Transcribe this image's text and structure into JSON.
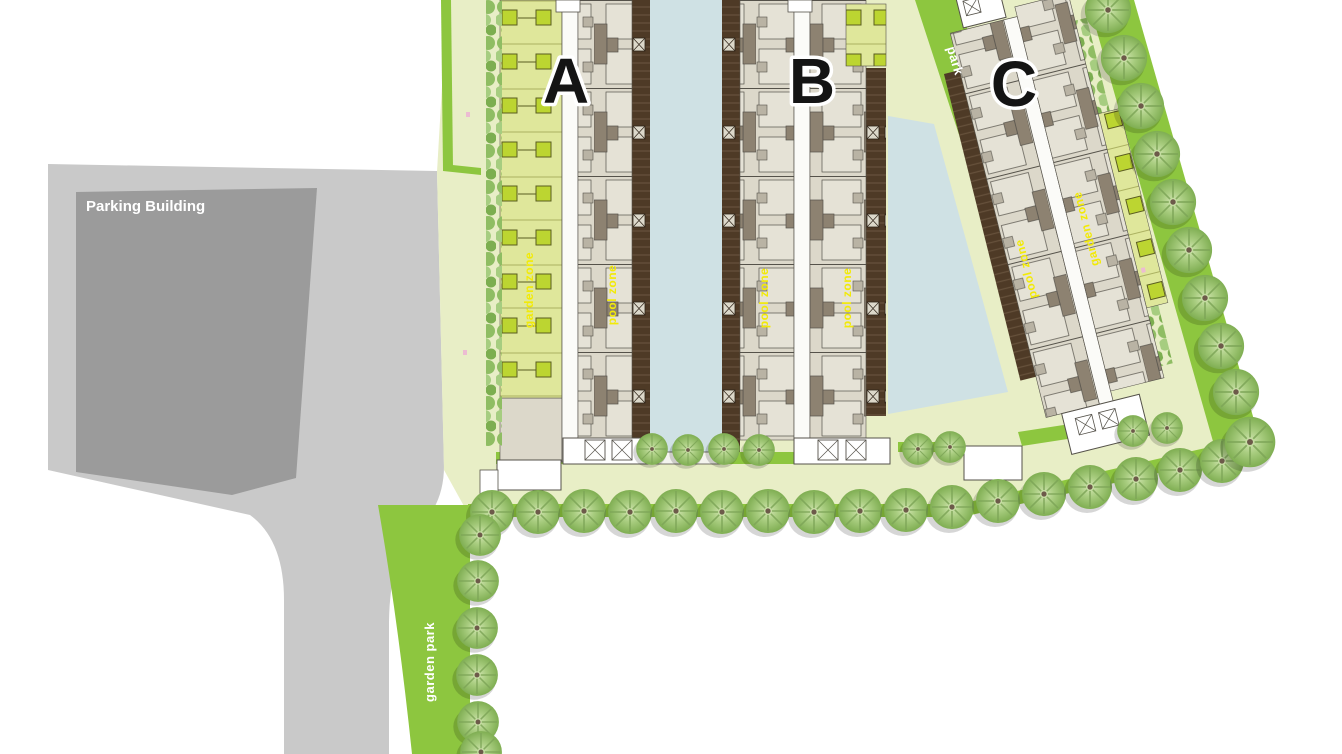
{
  "labels": {
    "parking_building": "Parking Building",
    "tower_a": "A",
    "tower_b": "B",
    "tower_c": "C",
    "garden_park": "garden park",
    "park_ribbon": "park",
    "zones": {
      "a_garden": "garden zone",
      "a_pool": "pool zone",
      "b_pool_left": "pool zone",
      "b_pool_right": "pool zone",
      "c_pool": "pool zone",
      "c_garden": "garden zone"
    }
  },
  "colors": {
    "bg": "#ffffff",
    "roadGray": "#c9c9c9",
    "parkGray": "#9b9b9b",
    "field": "#e8eec6",
    "green": "#8dc63f",
    "pool": "#cfe1e4",
    "deckBrown": "#4e3a26",
    "deckLine": "#66513b",
    "beige": "#dcd8ca",
    "beige2": "#e5e2d6",
    "taupe": "#8d8271",
    "taupe2": "#b9b3a4",
    "ink": "#55524a",
    "lime": "#dfe79b",
    "limeSq": "#bcd531",
    "limeInk": "#5a5c20",
    "corridor": "#fbfbf8",
    "labelYellow": "#f2ea07",
    "letter": "#141414",
    "white": "#ffffff",
    "pink": "#ecbcd2"
  }
}
